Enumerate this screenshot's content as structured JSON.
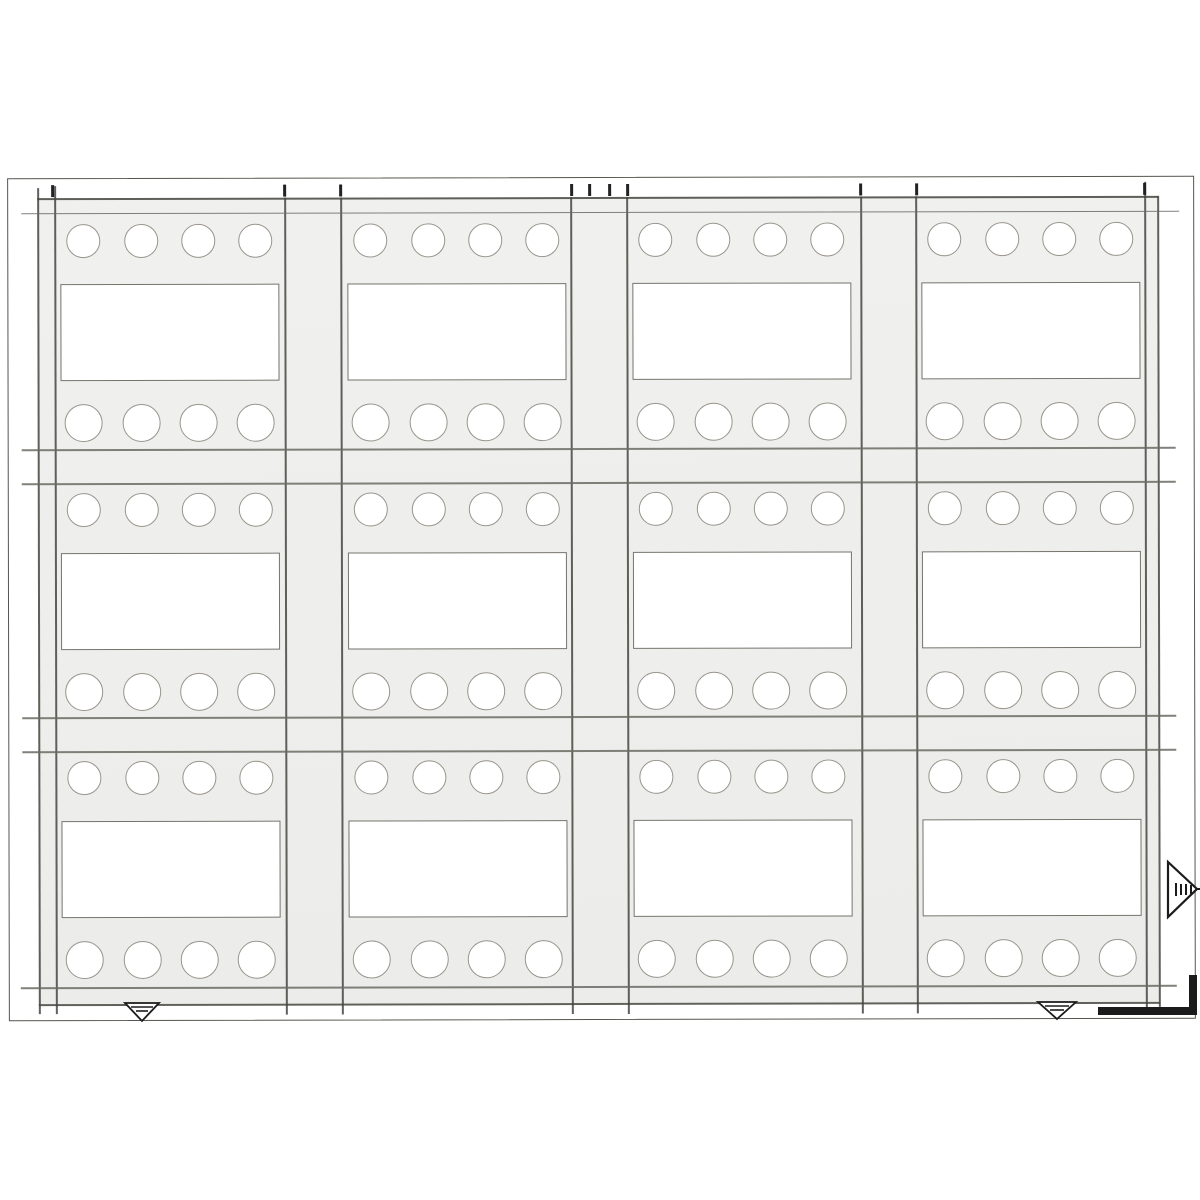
{
  "drawing": {
    "description": "Scanned engineering drawing of a stamped sheet panel: a 4 by 3 grid of identical modules, each module with four round holes along the top, a large rectangular cutout in the middle and four round holes along the bottom; alignment tick marks around the border, a grain-direction triangle marker on the right edge, two inverted datum triangles on the bottom edge and a thick corner registration mark at bottom right",
    "colors": {
      "background": "#ffffff",
      "panel_fill": "#f0f0ee",
      "panel_fill_deep": "#ececea",
      "frame_line": "#55554f",
      "main_line": "#45453f",
      "soft_line": "#6b6b64",
      "hole_outline": "#99958c",
      "slot_outline": "#76736b",
      "mark": "#1b1b1b",
      "tick": "#222220"
    },
    "page_frame": {
      "x": 8,
      "y": 177,
      "w": 1187,
      "h": 843
    },
    "panel": {
      "x": 38,
      "y": 197,
      "w": 1121,
      "h": 806
    },
    "grid": {
      "columns": [
        {
          "x": 55,
          "w": 230
        },
        {
          "x": 342,
          "w": 229
        },
        {
          "x": 627,
          "w": 234
        },
        {
          "x": 916,
          "w": 229
        }
      ],
      "rows": [
        {
          "y": 213,
          "h": 235
        },
        {
          "y": 482,
          "h": 234
        },
        {
          "y": 750,
          "h": 236
        }
      ],
      "module": {
        "hole_cx": [
          29,
          87,
          144,
          201
        ],
        "top_hole_cy": 27,
        "top_hole_r": 17,
        "bottom_hole_cy": 209,
        "bottom_hole_r": 19,
        "slot": {
          "x": 6,
          "y": 70,
          "w": 219,
          "h": 97
        }
      }
    },
    "v_lines": [
      {
        "x": 38,
        "y1": 187,
        "y2": 1013,
        "w": 1.5,
        "name": "panel-left-outer-edge-line"
      },
      {
        "x": 55,
        "y1": 185,
        "y2": 1013,
        "w": 1.5,
        "name": "panel-left-inner-edge-line"
      },
      {
        "x": 285,
        "y1": 197,
        "y2": 1014,
        "w": 1.6,
        "name": "column-divider-line"
      },
      {
        "x": 341,
        "y1": 197,
        "y2": 1014,
        "w": 1.6,
        "name": "column-divider-line"
      },
      {
        "x": 571,
        "y1": 197,
        "y2": 1014,
        "w": 1.6,
        "name": "column-divider-line"
      },
      {
        "x": 627,
        "y1": 197,
        "y2": 1014,
        "w": 1.6,
        "name": "column-divider-line"
      },
      {
        "x": 861,
        "y1": 197,
        "y2": 1014,
        "w": 1.6,
        "name": "column-divider-line"
      },
      {
        "x": 916,
        "y1": 197,
        "y2": 1014,
        "w": 1.6,
        "name": "column-divider-line"
      },
      {
        "x": 1145,
        "y1": 183,
        "y2": 1010,
        "w": 1.5,
        "name": "panel-right-inner-edge-line"
      },
      {
        "x": 1158,
        "y1": 197,
        "y2": 1008,
        "w": 1.8,
        "name": "panel-right-outer-edge-line"
      }
    ],
    "h_lines": [
      {
        "y": 197,
        "x1": 38,
        "x2": 1159,
        "w": 2.0,
        "name": "panel-top-outer-edge-line"
      },
      {
        "y": 212,
        "x1": 22,
        "x2": 1180,
        "w": 1.4,
        "name": "panel-top-inner-edge-line"
      },
      {
        "y": 448,
        "x1": 22,
        "x2": 1176,
        "w": 1.5,
        "name": "row-divider-line"
      },
      {
        "y": 482,
        "x1": 22,
        "x2": 1176,
        "w": 1.5,
        "name": "row-divider-line"
      },
      {
        "y": 716,
        "x1": 22,
        "x2": 1176,
        "w": 1.5,
        "name": "row-divider-line"
      },
      {
        "y": 750,
        "x1": 22,
        "x2": 1176,
        "w": 1.5,
        "name": "row-divider-line"
      },
      {
        "y": 986,
        "x1": 20,
        "x2": 1176,
        "w": 1.5,
        "name": "panel-bottom-inner-edge-line"
      },
      {
        "y": 1003,
        "x1": 38,
        "x2": 1159,
        "w": 2.0,
        "name": "panel-bottom-outer-edge-line"
      }
    ],
    "top_ticks": {
      "y": 184,
      "h": 12,
      "w": 3,
      "x_positions": [
        53,
        285,
        341,
        572,
        590,
        610,
        628,
        861,
        917,
        1145
      ]
    },
    "symbols": {
      "grain_marker": {
        "triangle": "1168,862 1168,917 1197,889",
        "dashes": [
          [
            1176,
            883,
            1176,
            896
          ],
          [
            1181,
            884,
            1181,
            895
          ],
          [
            1186,
            884,
            1186,
            895
          ],
          [
            1191,
            885,
            1191,
            894
          ]
        ],
        "tail": [
          1196,
          889,
          1200,
          889
        ]
      },
      "datum_triangles": [
        {
          "points": "125,1003 159,1003 142,1021",
          "dashes": [
            [
              131,
              1007,
              153,
              1007
            ],
            [
              136,
              1011,
              148,
              1011
            ]
          ]
        },
        {
          "points": "1038,1002 1076,1002 1057,1019",
          "dashes": [
            [
              1045,
              1006,
              1069,
              1006
            ],
            [
              1050,
              1010,
              1064,
              1010
            ]
          ]
        }
      ],
      "corner_mark": {
        "bars": [
          {
            "x": 1098,
            "y": 1007,
            "w": 99,
            "h": 8
          },
          {
            "x": 1189,
            "y": 975,
            "w": 8,
            "h": 40
          }
        ]
      }
    }
  }
}
